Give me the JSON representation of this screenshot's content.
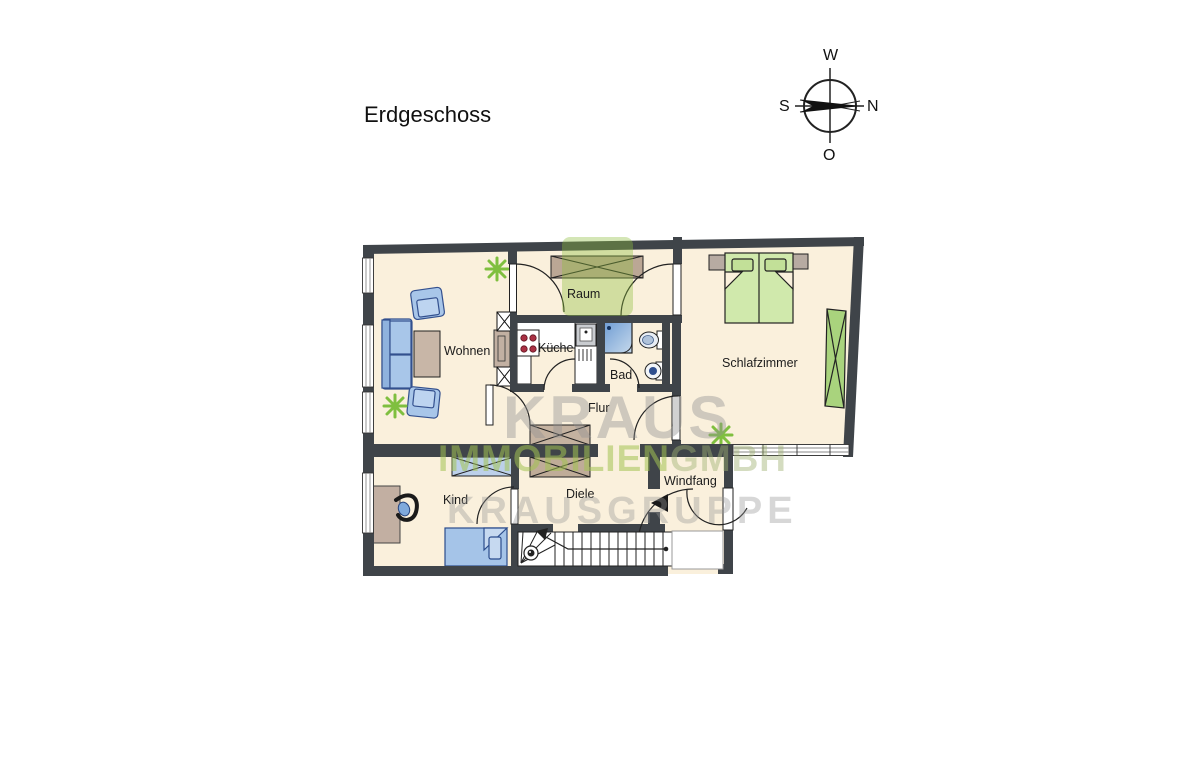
{
  "title": "Erdgeschoss",
  "compass": {
    "top": "W",
    "left": "S",
    "right": "N",
    "bottom": "O"
  },
  "rooms": {
    "raum": "Raum",
    "wohnen": "Wohnen",
    "kueche": "Küche",
    "bad": "Bad",
    "schlafzimmer": "Schlafzimmer",
    "flur": "Flur",
    "kind": "Kind",
    "diele": "Diele",
    "windfang": "Windfang"
  },
  "watermark": {
    "line1": "KRAUS",
    "line2a": "IMMOBILIEN",
    "line2b": "GMBH",
    "line3": "KRAUSGRUPPE"
  },
  "colors": {
    "wall": "#3F4449",
    "floor": "#FAF0DC",
    "furniture_blue": "#A8C6E9",
    "furniture_blue_border": "#33508E",
    "furniture_brown": "#C4B2A0",
    "bed_green": "#D0E9AC",
    "wardrobe_green": "#A9D37D",
    "plant_green": "#7FBF3F",
    "burner_red": "#A93043",
    "watermark_green": "#8FBC3F"
  }
}
